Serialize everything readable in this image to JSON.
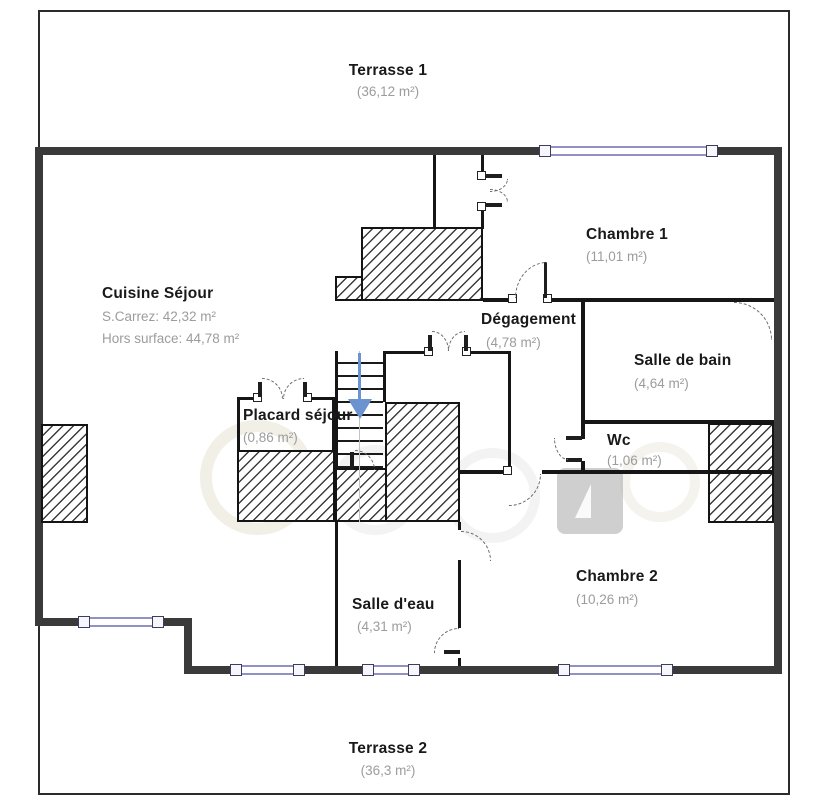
{
  "plan": {
    "type": "floor-plan",
    "rooms": [
      {
        "id": "terrasse1",
        "name": "Terrasse 1",
        "area": "(36,12 m²)"
      },
      {
        "id": "cuisine_sejour",
        "name": "Cuisine Séjour",
        "area1": "S.Carrez: 42,32 m²",
        "area2": "Hors surface: 44,78 m²"
      },
      {
        "id": "chambre1",
        "name": "Chambre 1",
        "area": "(11,01 m²)"
      },
      {
        "id": "degagement",
        "name": "Dégagement",
        "area": "(4,78 m²)"
      },
      {
        "id": "salle_de_bain",
        "name": "Salle de bain",
        "area": "(4,64 m²)"
      },
      {
        "id": "placard_sejour",
        "name": "Placard séjour",
        "area": "(0,86 m²)"
      },
      {
        "id": "wc",
        "name": "Wc",
        "area": "(1,06 m²)"
      },
      {
        "id": "chambre2",
        "name": "Chambre 2",
        "area": "(10,26 m²)"
      },
      {
        "id": "salle_deau",
        "name": "Salle d'eau",
        "area": "(4,31 m²)"
      },
      {
        "id": "terrasse2",
        "name": "Terrasse 2",
        "area": "(36,3 m²)"
      }
    ],
    "colors": {
      "exterior_wall": "#3a3a3a",
      "interior_wall": "#161616",
      "window_accent": "#9191c6",
      "stairs_arrow": "#6a93cf",
      "room_name_text": "#191919",
      "room_area_text": "#9c9c9c",
      "background": "#ffffff"
    }
  }
}
